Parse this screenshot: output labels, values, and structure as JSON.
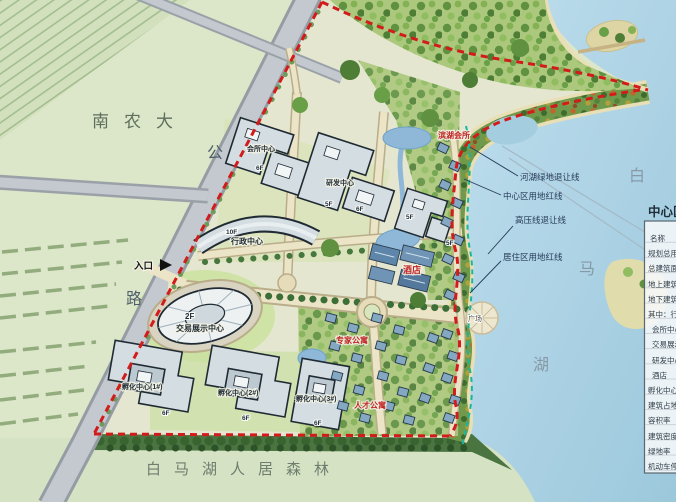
{
  "area_labels": {
    "university": "南农大",
    "road_char_top": "公",
    "road_char_bottom": "路",
    "lake_char_1": "白",
    "lake_char_2": "马",
    "lake_char_3": "湖",
    "forest_banner": "白马湖人居森林",
    "entrance": "入口",
    "plaza": "广场"
  },
  "setback_labels": {
    "river_green": "河湖绿地退让线",
    "center_red": "中心区用地红线",
    "high_voltage": "高压线退让线",
    "residential_red": "居住区用地红线"
  },
  "building_labels": {
    "club_center": "会所中心",
    "rd_center": "研发中心",
    "admin_center": "行政中心",
    "trade_center": "交易展示中心",
    "incubator_1": "孵化中心(1#)",
    "incubator_2": "孵化中心(2#)",
    "incubator_3": "孵化中心(3#)"
  },
  "red_labels": {
    "hotel": "酒店",
    "lakeside_club": "滨湖会所",
    "expert_apartments": "专家公寓",
    "talent_apartments": "人才公寓"
  },
  "floor_tags": [
    "6F",
    "5F",
    "6F",
    "5F",
    "5F",
    "10F",
    "2F",
    "6F",
    "6F",
    "6F"
  ],
  "legend": {
    "title": "中心区经济技术指标",
    "rows": [
      "名称",
      "规划总用地面积",
      "总建筑面积",
      "地上建筑面积",
      "地下建筑面积",
      "其中：行政中心",
      "会所中心",
      "交易展示中心",
      "研发中心",
      "酒店",
      "孵化中心",
      "建筑占地面积",
      "容积率",
      "建筑密度",
      "绿地率",
      "机动车停车位"
    ]
  },
  "colors": {
    "boundary_red": "#d21c1c",
    "setback_green": "#17b79e",
    "red_label": "#c22525",
    "lake": "#aed2e4"
  }
}
